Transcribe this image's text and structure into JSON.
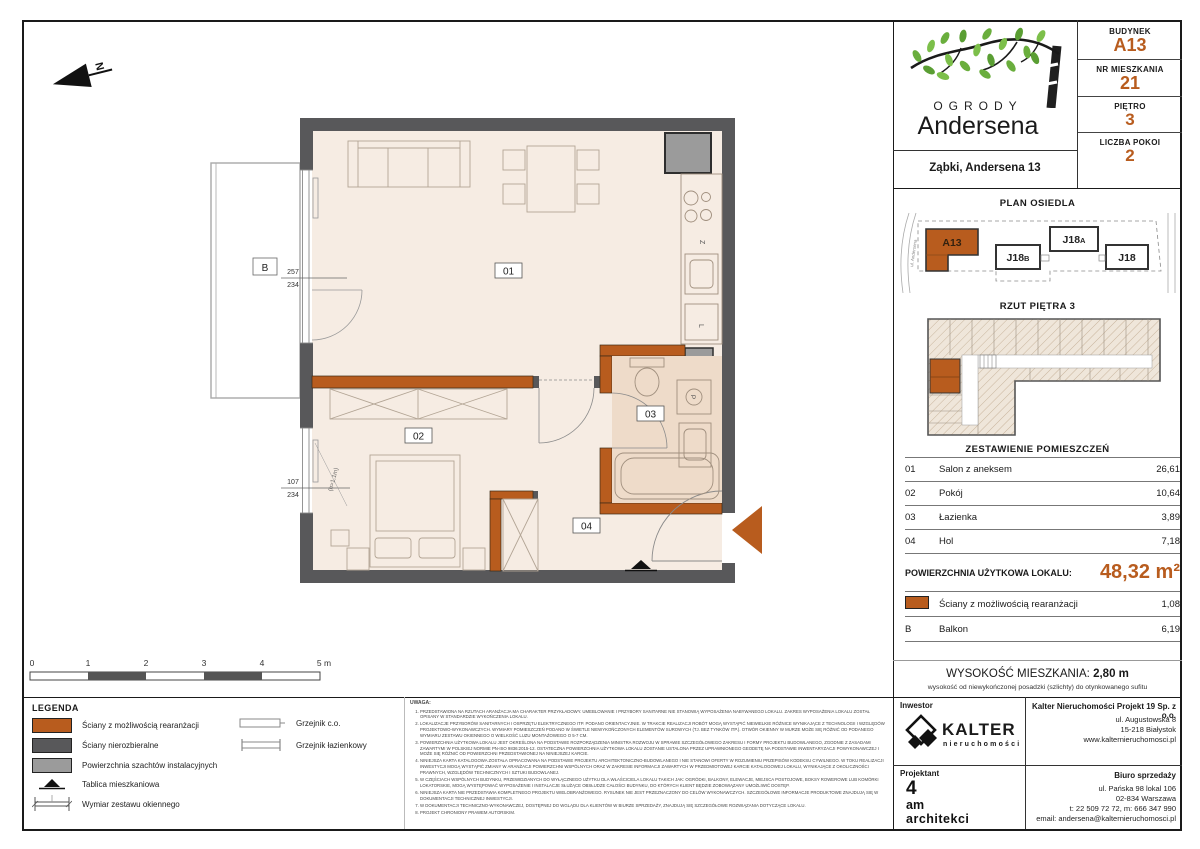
{
  "compass": {
    "label": "N"
  },
  "plan": {
    "room_labels": [
      {
        "id": "01"
      },
      {
        "id": "02"
      },
      {
        "id": "03"
      },
      {
        "id": "04"
      }
    ],
    "balcony_label": "B",
    "dimensions": {
      "balcony_window_top": "257",
      "balcony_window_bottom": "234",
      "bedroom_window_top": "107",
      "bedroom_window_bottom": "234",
      "window_height_note": "(h=1,1m)"
    },
    "fixture_letters": {
      "sink": "Z",
      "fridge": "L",
      "washer": "P"
    }
  },
  "scale_bar": {
    "labels": [
      "0",
      "1",
      "2",
      "3",
      "4",
      "5 m"
    ]
  },
  "legend": {
    "title": "LEGENDA",
    "swatch_items": [
      {
        "color": "#b85c1e",
        "label": "Ściany z możliwością rearanżacji"
      },
      {
        "color": "#58585a",
        "label": "Ściany nierozbieralne"
      },
      {
        "color": "#9b9b9b",
        "label": "Powierzchnia szachtów instalacyjnych"
      }
    ],
    "symbol_items": [
      {
        "icon": "tablica-icon",
        "label": "Tablica mieszkaniowa"
      },
      {
        "icon": "window-dim-icon",
        "label": "Wymiar zestawu okiennego"
      }
    ],
    "column2": [
      {
        "icon": "radiator-co-icon",
        "label": "Grzejnik c.o."
      },
      {
        "icon": "radiator-bath-icon",
        "label": "Grzejnik łazienkowy"
      }
    ]
  },
  "notes": {
    "title": "UWAGA:",
    "items": [
      "PRZEDSTAWIONA NA RZUTACH ARANŻACJA MA CHARAKTER PRZYKŁADOWY. UMEBLOWANIE I PRZYBORY SANITARNE NIE STANOWIĄ WYPOSAŻENIA NABYWANEGO LOKALU. ZAKRES WYPOSAŻENIA LOKALU ZOSTAŁ OPISANY W STANDARDZIE WYKOŃCZENIA LOKALU.",
      "LOKALIZACJE PRZYBORÓW SANITARNYCH I OSPRZĘTU ELEKTRYCZNEGO ITP. PODANO ORIENTACYJNIE. W TRAKCIE REALIZACJI ROBÓT MOGĄ WYSTĄPIĆ NIEWIELKIE RÓŻNICE WYNIKAJĄCE Z TECHNOLOGII I WZGLĘDÓW PROJEKTOWO-WYKONAWCZYCH. WYMIARY POMIESZCZEŃ PODANO W ŚWIETLE NIEWYKOŃCZONYCH ELEMENTÓW SUROWYCH (TJ. BEZ TYNKÓW ITP.). OTWÓR OKIENNY W MURZE MOŻE SIĘ RÓŻNIĆ OD PODANEGO WYMIARU ZESTAWU OKIENNEGO O WIELKOŚĆ LUZU MONTAŻOWEGO O 5-7 CM.",
      "POWIERZCHNIA UŻYTKOWA LOKALU JEST OKREŚLONA NA PODSTAWIE ROZPORZĄDZENIA MINISTRA ROZWOJU W SPRAWIE SZCZEGÓŁOWEGO ZAKRESU I FORMY PROJEKTU BUDOWLANEGO, ZGODNIE Z ZASADAMI ZAWARTYMI W POLSKIEJ NORMIE PN-ISO 9836:2015-12. OSTATECZNA POWIERZCHNIA UŻYTKOWA LOKALU ZOSTANIE USTALONA PRZEZ UPRAWNIONEGO GEODETĘ NA PODSTAWIE INWENTARYZACJI POWYKONAWCZEJ I MOŻE SIĘ RÓŻNIĆ OD POWIERZCHNI PRZEDSTAWIONEJ NA NINIEJSZEJ KARCIE.",
      "NINIEJSZA KARTA KATALOGOWA ZOSTAŁA OPRACOWANA NA PODSTAWIE PROJEKTU ARCHITEKTONICZNO-BUDOWLANEGO I NIE STANOWI OFERTY W ROZUMIENIU PRZEPISÓW KODEKSU CYWILNEGO. W TOKU REALIZACJI INWESTYCJI MOGĄ WYSTĄPIĆ ZMIANY W ARANŻACJI POWIERZCHNI WSPÓLNYCH ORAZ W ZAKRESIE INFORMACJI ZAWARTYCH W PRZEDMIOTOWEJ KARCIE KATALOGOWEJ LOKALU, WYNIKAJĄCE Z OKOLICZNOŚCI PRAWNYCH, WZGLĘDÓW TECHNICZNYCH I SZTUKI BUDOWLANEJ.",
      "W CZĘŚCIACH WSPÓLNYCH BUDYNKU, PRZEWIDZIANYCH DO WYŁĄCZNEGO UŻYTKU DLA WŁAŚCICIELA LOKALU TAKICH JAK: OGRÓDKI, BALKONY, ELEWACJE, MIEJSCA POSTOJOWE, BOKSY ROWEROWE LUB KOMÓRKI LOKATORSKIE, MOGĄ WYSTĘPOWAĆ WYPOSAŻENIE I INSTALACJE SŁUŻĄCE OBSŁUDZE CAŁOŚCI BUDYNKU, DO KTÓRYCH KLIENT BĘDZIE ZOBOWIĄZANY UMOŻLIWIĆ DOSTĘP.",
      "NINIEJSZA KARTA NIE PRZEDSTAWIA KOMPLETNEGO PROJEKTU WIELOBRANŻOWEGO. RYSUNEK NIE JEST PRZEZNACZONY DO CELÓW WYKONAWCZYCH. SZCZEGÓŁOWE INFORMACJE PRODUKTOWE ZNAJDUJĄ SIĘ W DOKUMENTACJI TECHNICZNEJ INWESTYCJI.",
      "W DOKUMENTACJI TECHNICZNO-WYKONAWCZEJ, DOSTĘPNEJ DO WGLĄDU DLA KLIENTÓW W BIURZE SPRZEDAŻY, ZNAJDUJĄ SIĘ SZCZEGÓŁOWE ROZWIĄZANIA DOTYCZĄCE LOKALU.",
      "PROJEKT CHRONIONY PRAWEM AUTORSKIM."
    ]
  },
  "sidebar": {
    "logo": {
      "word1": "OGRODY",
      "word2": "Andersena"
    },
    "address": "Ząbki, Andersena 13",
    "unit_info": [
      {
        "label": "BUDYNEK",
        "value": "A13"
      },
      {
        "label": "NR MIESZKANIA",
        "value": "21"
      },
      {
        "label": "PIĘTRO",
        "value": "3"
      },
      {
        "label": "LICZBA POKOI",
        "value": "2"
      }
    ],
    "site_plan": {
      "title": "PLAN OSIEDLA",
      "street_left": "ul. Andersena",
      "buildings": [
        {
          "name": "A13",
          "suffix": ""
        },
        {
          "name": "J18",
          "suffix": "B"
        },
        {
          "name": "J18",
          "suffix": "A"
        },
        {
          "name": "J18",
          "suffix": ""
        }
      ]
    },
    "floor_plan": {
      "title": "RZUT PIĘTRA 3"
    },
    "rooms_table": {
      "title": "ZESTAWIENIE POMIESZCZEŃ",
      "rows": [
        {
          "no": "01",
          "name": "Salon z aneksem",
          "area": "26,61"
        },
        {
          "no": "02",
          "name": "Pokój",
          "area": "10,64"
        },
        {
          "no": "03",
          "name": "Łazienka",
          "area": "3,89"
        },
        {
          "no": "04",
          "name": "Hol",
          "area": "7,18"
        }
      ],
      "total_label": "POWIERZCHNIA UŻYTKOWA LOKALU:",
      "total_value": "48,32 m²",
      "extra_rows": [
        {
          "marker": "swatch",
          "label": "Ściany z możliwością rearanżacji",
          "area": "1,08"
        },
        {
          "marker": "B",
          "label": "Balkon",
          "area": "6,19"
        }
      ]
    },
    "height_info": {
      "label": "WYSOKOŚĆ MIESZKANIA:",
      "value": "2,80 m",
      "note": "wysokość od niewykończonej posadzki (szlichty) do otynkowanego sufitu"
    },
    "investor": {
      "role": "Inwestor",
      "brand": "KALTER",
      "brand_sub": "nieruchomości",
      "company": "Kalter Nieruchomości Projekt 19 Sp. z o.o.",
      "address_lines": [
        "ul. Augustowska 8",
        "15-218 Białystok",
        "www.kalternieruchomosci.pl"
      ]
    },
    "designer": {
      "role": "Projektant",
      "studio_lines": [
        "4",
        "am",
        "architekci"
      ],
      "office_title": "Biuro sprzedaży",
      "office_lines": [
        "ul. Pańska 98 lokal 106",
        "02-834 Warszawa",
        "t: 22 509 72 72, m: 666 347 990",
        "email: andersena@kalternieruchomosci.pl"
      ]
    }
  },
  "colors": {
    "accent": "#b85c1e",
    "wall": "#58585a",
    "shaft": "#9b9b9b",
    "floor": "#f6ece3",
    "floor_bath": "#eedbc9",
    "leaf": "#6aae3d"
  }
}
